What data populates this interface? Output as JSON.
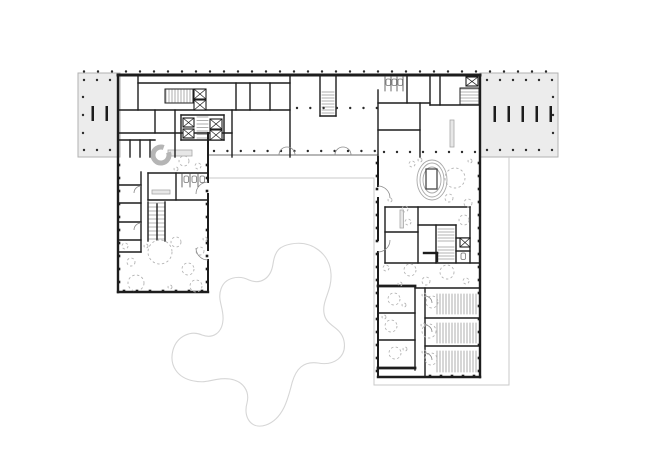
{
  "document": {
    "kind": "architectural-floor-plan",
    "visible_text": []
  },
  "colors": {
    "paper": "#ffffff",
    "wall": "#1d1d1d",
    "thin": "#6f6f6f",
    "hatch": "#9a9a9a",
    "lightFill": "#ececec",
    "lightStroke": "#b2b2b2",
    "counterFill": "#e7e7e7",
    "counterStroke": "#a8a8a8",
    "dash": "#b4b4b4",
    "canopy": "#c9c9c9",
    "blob": "#d6d6d6",
    "dot": "#2b2b2b",
    "spiral": "#b5b5b5",
    "ovalStroke": "#a9a9a9"
  },
  "canvas": {
    "w": 650,
    "h": 473
  },
  "plan": {
    "annexes": [
      [
        78,
        73,
        42,
        84
      ],
      [
        480,
        73,
        78,
        84
      ]
    ],
    "canopyOutline": "208,178 374,178 374,385 509,385 509,157",
    "blobPath": "M 291,244 C 312,240 330,254 331,274 C 332,291 322,300 324,313 C 326,327 341,326 344,341 C 347,357 334,366 318,363 C 303,361 296,369 292,383 C 288,399 283,419 266,425 C 251,430 243,417 247,403 C 250,391 243,381 230,379 C 216,377 208,384 194,381 C 177,378 169,365 173,350 C 177,336 191,330 202,335 C 213,339 222,333 223,320 C 224,308 217,300 221,289 C 225,277 239,275 249,280 C 261,285 271,278 273,264 C 275,250 280,246 291,244 Z",
    "thinLines": [
      [
        208,
        155,
        378,
        155
      ]
    ],
    "outerWalls": [
      [
        118,
        75,
        480,
        75,
        3
      ],
      [
        118,
        75,
        118,
        292,
        2.4
      ],
      [
        118,
        292,
        208,
        292,
        2.4
      ],
      [
        480,
        75,
        480,
        377,
        2.4
      ],
      [
        378,
        377,
        480,
        377,
        2.4
      ],
      [
        208,
        133,
        208,
        182,
        2
      ],
      [
        208,
        194,
        208,
        250,
        2
      ],
      [
        208,
        260,
        208,
        292,
        2
      ],
      [
        378,
        157,
        378,
        186,
        2
      ],
      [
        378,
        198,
        378,
        240,
        2
      ],
      [
        378,
        252,
        378,
        377,
        2
      ],
      [
        378,
        286,
        415,
        286,
        2.8
      ],
      [
        378,
        368,
        415,
        368,
        2.8
      ]
    ],
    "innerWalls": [
      [
        138,
        83,
        290,
        83
      ],
      [
        236,
        83,
        236,
        110
      ],
      [
        250,
        83,
        250,
        110
      ],
      [
        270,
        83,
        270,
        110
      ],
      [
        138,
        75,
        138,
        110
      ],
      [
        118,
        110,
        290,
        110
      ],
      [
        118,
        133,
        232,
        133
      ],
      [
        155,
        110,
        155,
        133
      ],
      [
        175,
        110,
        175,
        157
      ],
      [
        232,
        110,
        232,
        157
      ],
      [
        290,
        75,
        290,
        157
      ],
      [
        181,
        115,
        224,
        115
      ],
      [
        181,
        140,
        224,
        140
      ],
      [
        181,
        115,
        181,
        140
      ],
      [
        224,
        115,
        224,
        140
      ],
      [
        130,
        140,
        130,
        157
      ],
      [
        140,
        140,
        140,
        157
      ],
      [
        150,
        140,
        150,
        157
      ],
      [
        118,
        140,
        155,
        140
      ],
      [
        320,
        75,
        320,
        116
      ],
      [
        336,
        75,
        336,
        116
      ],
      [
        320,
        116,
        336,
        116
      ],
      [
        378,
        90,
        378,
        157
      ],
      [
        378,
        103,
        430,
        103
      ],
      [
        407,
        75,
        407,
        103
      ],
      [
        430,
        75,
        430,
        105
      ],
      [
        430,
        105,
        480,
        105
      ],
      [
        440,
        75,
        440,
        105
      ],
      [
        378,
        130,
        420,
        130
      ],
      [
        420,
        103,
        420,
        157
      ],
      [
        148,
        173,
        208,
        173
      ],
      [
        148,
        173,
        148,
        200
      ],
      [
        148,
        200,
        208,
        200
      ],
      [
        176,
        173,
        176,
        200
      ],
      [
        141,
        172,
        141,
        252
      ],
      [
        118,
        185,
        141,
        185
      ],
      [
        118,
        203,
        141,
        203
      ],
      [
        118,
        222,
        141,
        222
      ],
      [
        118,
        240,
        141,
        240
      ],
      [
        118,
        252,
        141,
        252
      ],
      [
        148,
        202,
        148,
        241
      ],
      [
        165,
        202,
        165,
        241
      ],
      [
        157,
        204,
        157,
        240
      ],
      [
        385,
        207,
        470,
        207
      ],
      [
        385,
        207,
        385,
        263
      ],
      [
        470,
        207,
        470,
        263
      ],
      [
        385,
        263,
        480,
        263
      ],
      [
        418,
        207,
        418,
        263
      ],
      [
        385,
        232,
        418,
        232
      ],
      [
        436,
        225,
        436,
        263
      ],
      [
        418,
        225,
        456,
        225
      ],
      [
        456,
        225,
        456,
        263
      ],
      [
        456,
        238,
        470,
        238
      ],
      [
        456,
        251,
        470,
        251
      ],
      [
        424,
        253,
        437,
        253,
        2.4
      ],
      [
        437,
        253,
        437,
        261,
        2.4
      ],
      [
        415,
        286,
        415,
        370
      ],
      [
        378,
        313,
        415,
        313
      ],
      [
        378,
        340,
        415,
        340
      ],
      [
        415,
        288,
        480,
        288
      ],
      [
        425,
        288,
        425,
        377
      ],
      [
        425,
        318,
        480,
        318
      ],
      [
        425,
        346,
        480,
        346
      ]
    ],
    "hatches": [
      {
        "x": 166,
        "y": 90,
        "w": 26,
        "h": 12,
        "step": 3,
        "dir": "v",
        "box": true
      },
      {
        "x": 197,
        "y": 117,
        "w": 11,
        "h": 22,
        "step": 3.5,
        "dir": "h",
        "box": false
      },
      {
        "x": 322,
        "y": 92,
        "w": 12,
        "h": 22,
        "step": 3,
        "dir": "h",
        "box": false
      },
      {
        "x": 461,
        "y": 89,
        "w": 17,
        "h": 15,
        "step": 3,
        "dir": "h",
        "box": true
      },
      {
        "x": 149,
        "y": 203,
        "w": 16,
        "h": 37,
        "step": 4,
        "dir": "h",
        "box": false
      },
      {
        "x": 438,
        "y": 229,
        "w": 16,
        "h": 13,
        "step": 3,
        "dir": "h",
        "box": false
      },
      {
        "x": 438,
        "y": 247,
        "w": 16,
        "h": 14,
        "step": 3,
        "dir": "h",
        "box": false
      },
      {
        "x": 437,
        "y": 294,
        "w": 40,
        "h": 20,
        "step": 3,
        "dir": "v",
        "box": false
      },
      {
        "x": 437,
        "y": 323,
        "w": 40,
        "h": 20,
        "step": 3,
        "dir": "v",
        "box": false
      },
      {
        "x": 437,
        "y": 351,
        "w": 40,
        "h": 21,
        "step": 3,
        "dir": "v",
        "box": false
      }
    ],
    "shafts": [
      [
        194,
        89,
        12,
        10
      ],
      [
        194,
        100,
        12,
        10
      ],
      [
        183,
        118,
        11,
        9
      ],
      [
        183,
        129,
        11,
        9
      ],
      [
        210,
        119,
        12,
        10
      ],
      [
        210,
        130,
        12,
        10
      ],
      [
        466,
        77,
        12,
        9
      ],
      [
        460,
        238,
        10,
        9
      ]
    ],
    "stallLines": [
      [
        385,
        77,
        385,
        91
      ],
      [
        391,
        77,
        391,
        91
      ],
      [
        397,
        77,
        397,
        91
      ],
      [
        403,
        77,
        403,
        91
      ],
      [
        182,
        173,
        182,
        187
      ],
      [
        190,
        173,
        190,
        187
      ],
      [
        198,
        173,
        198,
        187
      ]
    ],
    "fixtures": [
      [
        386,
        79
      ],
      [
        392,
        79
      ],
      [
        398,
        79
      ],
      [
        184,
        176
      ],
      [
        192,
        176
      ],
      [
        200,
        176
      ],
      [
        461,
        253
      ]
    ],
    "counters": [
      [
        168,
        150,
        24,
        6
      ],
      [
        152,
        190,
        18,
        4
      ],
      [
        450,
        120,
        4,
        27
      ],
      [
        400,
        210,
        3.5,
        18
      ]
    ],
    "wallStubs": [
      [
        91.5,
        106,
        2.5,
        15
      ],
      [
        105.5,
        106,
        2.5,
        15
      ],
      [
        493.5,
        106,
        2.5,
        16
      ],
      [
        507.5,
        106,
        2.5,
        16
      ],
      [
        521.5,
        106,
        2.5,
        16
      ],
      [
        535.5,
        106,
        2.5,
        16
      ],
      [
        549.5,
        106,
        2.5,
        16
      ]
    ],
    "dotRows": [
      {
        "x": 84,
        "y": 71.5,
        "n": 34,
        "dx": 14,
        "dy": 0
      },
      {
        "x": 84,
        "y": 80,
        "n": 3,
        "dx": 13,
        "dy": 0
      },
      {
        "x": 84,
        "y": 150,
        "n": 3,
        "dx": 13,
        "dy": 0
      },
      {
        "x": 83,
        "y": 97,
        "n": 3,
        "dx": 0,
        "dy": 18
      },
      {
        "x": 487,
        "y": 80,
        "n": 6,
        "dx": 13,
        "dy": 0
      },
      {
        "x": 487,
        "y": 150,
        "n": 6,
        "dx": 13,
        "dy": 0
      },
      {
        "x": 553,
        "y": 97,
        "n": 3,
        "dx": 0,
        "dy": 18
      },
      {
        "x": 214,
        "y": 151,
        "n": 13,
        "dx": 13.4,
        "dy": 0
      },
      {
        "x": 297,
        "y": 108,
        "n": 7,
        "dx": 13.3,
        "dy": 0
      },
      {
        "x": 384,
        "y": 152,
        "n": 8,
        "dx": 13,
        "dy": 0
      }
    ],
    "wallTicks": [
      {
        "x": 479,
        "y": 163,
        "n": 17,
        "dx": 0,
        "dy": 13
      },
      {
        "x": 377,
        "y": 163,
        "n": 17,
        "dx": 0,
        "dy": 13
      },
      {
        "x": 430,
        "y": 376,
        "n": 5,
        "dx": 11,
        "dy": 0
      },
      {
        "x": 119,
        "y": 165,
        "n": 10,
        "dx": 0,
        "dy": 13
      },
      {
        "x": 207,
        "y": 165,
        "n": 10,
        "dx": 0,
        "dy": 13
      },
      {
        "x": 124,
        "y": 291,
        "n": 7,
        "dx": 13,
        "dy": 0
      }
    ],
    "dashedCircles": [
      [
        184,
        161,
        5
      ],
      [
        198,
        166,
        3
      ],
      [
        176,
        169,
        2
      ],
      [
        160,
        252,
        12
      ],
      [
        136,
        283,
        8
      ],
      [
        188,
        269,
        6
      ],
      [
        176,
        242,
        5
      ],
      [
        200,
        251,
        4
      ],
      [
        131,
        262,
        4
      ],
      [
        196,
        286,
        6
      ],
      [
        146,
        246,
        2
      ],
      [
        170,
        287,
        2
      ],
      [
        205,
        239,
        2
      ],
      [
        125,
        246,
        3
      ],
      [
        455,
        178,
        10
      ],
      [
        449,
        198,
        4
      ],
      [
        412,
        164,
        3
      ],
      [
        468,
        203,
        4
      ],
      [
        405,
        209,
        3
      ],
      [
        464,
        220,
        5
      ],
      [
        408,
        222,
        3
      ],
      [
        390,
        200,
        2
      ],
      [
        470,
        161,
        2
      ],
      [
        420,
        160,
        2
      ],
      [
        410,
        270,
        6
      ],
      [
        447,
        272,
        7
      ],
      [
        426,
        281,
        4
      ],
      [
        386,
        268,
        3
      ],
      [
        466,
        281,
        3
      ],
      [
        400,
        284,
        2
      ],
      [
        394,
        299,
        6
      ],
      [
        404,
        305,
        2
      ],
      [
        391,
        326,
        6
      ],
      [
        384,
        317,
        2
      ],
      [
        395,
        353,
        6
      ],
      [
        405,
        349,
        2
      ],
      [
        432,
        302,
        6
      ],
      [
        429,
        331,
        7
      ],
      [
        431,
        359,
        6
      ],
      [
        424,
        295,
        2
      ],
      [
        423,
        325,
        2
      ],
      [
        424,
        352,
        2
      ]
    ],
    "spiralStair": {
      "cx": 161,
      "cy": 155,
      "r": 8,
      "path": "M 163.7,147.5 A 8,8 0 1 0 168.5,152.3"
    },
    "oval": {
      "cx": 432,
      "cy": 180,
      "rx": [
        15,
        12,
        9
      ],
      "ry": [
        20,
        17,
        13
      ],
      "rect": [
        426,
        169,
        11,
        20
      ]
    },
    "doors": [
      "M279,155 A8,8 0 0 1 287,147",
      "M295,155 A8,8 0 0 0 287,147",
      "M335,155 A8,8 0 0 1 343,147",
      "M351,155 A8,8 0 0 0 343,147",
      "M378,186 A12,12 0 0 1 390,198",
      "M378,252 A12,12 0 0 0 390,240",
      "M208,182 A12,12 0 0 0 196,194",
      "M208,260 A12,12 0 0 1 196,248",
      "M141,186 A7,7 0 0 0 134,193",
      "M141,223 A7,7 0 0 0 134,230",
      "M425,296 A7,7 0 0 1 432,303",
      "M425,325 A7,7 0 0 1 432,332",
      "M425,353 A7,7 0 0 1 432,360"
    ]
  }
}
